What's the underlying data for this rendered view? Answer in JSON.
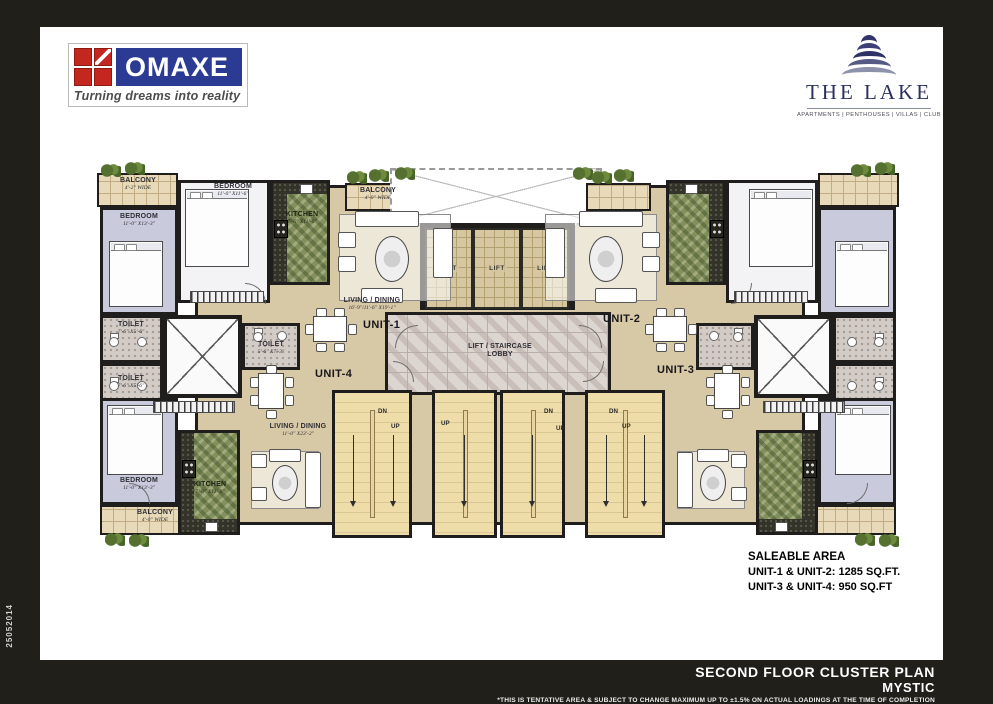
{
  "frame": {
    "side_code": "25052014"
  },
  "branding": {
    "omaxe_name": "OMAXE",
    "omaxe_tagline": "Turning dreams into reality",
    "lake_name": "THE LAKE",
    "lake_subtitle": "APARTMENTS | PENTHOUSES | VILLAS | CLUB"
  },
  "colors": {
    "omaxe_blue": "#2b3a92",
    "omaxe_red": "#c42620",
    "lake_navy": "#2e3266"
  },
  "saleable": {
    "heading": "SALEABLE AREA",
    "units12": "UNIT-1 & UNIT-2: 1285 SQ.FT.",
    "units34": "UNIT-3 & UNIT-4: 950 SQ.FT"
  },
  "footer": {
    "title": "SECOND FLOOR CLUSTER PLAN",
    "subtitle": "MYSTIC",
    "disclaimer": "*THIS IS TENTATIVE AREA & SUBJECT TO CHANGE MAXIMUM UP TO ±1.5% ON ACTUAL  LOADINGS AT THE TIME OF COMPLETION"
  },
  "units": {
    "u1": "UNIT-1",
    "u2": "UNIT-2",
    "u3": "UNIT-3",
    "u4": "UNIT-4"
  },
  "rooms": {
    "balcony_tl": {
      "name": "BALCONY",
      "dim": "4'-2\" WIDE"
    },
    "bedroom_left_top": {
      "name": "BEDROOM",
      "dim": "11'-0\" X13'-3\""
    },
    "bedroom_top": {
      "name": "BEDROOM",
      "dim": "11'-0\" X11'-6\""
    },
    "kitchen_top": {
      "name": "KITCHEN",
      "dim": "7'-6\" X11'-6\""
    },
    "balcony_u1": {
      "name": "BALCONY",
      "dim": "4'-0\" WIDE"
    },
    "living_u1": {
      "name": "LIVING / DINING",
      "dim": "16'-9\"/11'-6\" X19'-1\""
    },
    "toilet_a": {
      "name": "TOILET",
      "dim": "7'-6\" X5'-6\""
    },
    "toilet_b": {
      "name": "TOILET",
      "dim": "7'-6\" X5'-6\""
    },
    "toilet_c": {
      "name": "TOILET",
      "dim": "5'-6\" X7'-3\""
    },
    "living_u4": {
      "name": "LIVING / DINING",
      "dim": "11'-0\" X23'-2\""
    },
    "bedroom_left_bottom": {
      "name": "BEDROOM",
      "dim": "11'-0\" X13'-3\""
    },
    "balcony_bl": {
      "name": "BALCONY",
      "dim": "4'-0\" WIDE"
    },
    "kitchen_bottom": {
      "name": "KITCHEN",
      "dim": "7'-0\" X11'-6\""
    },
    "lift": "LIFT",
    "lobby1": "LIFT / STAIRCASE",
    "lobby2": "LOBBY"
  },
  "stairs": {
    "up": "UP",
    "dn": "DN"
  }
}
